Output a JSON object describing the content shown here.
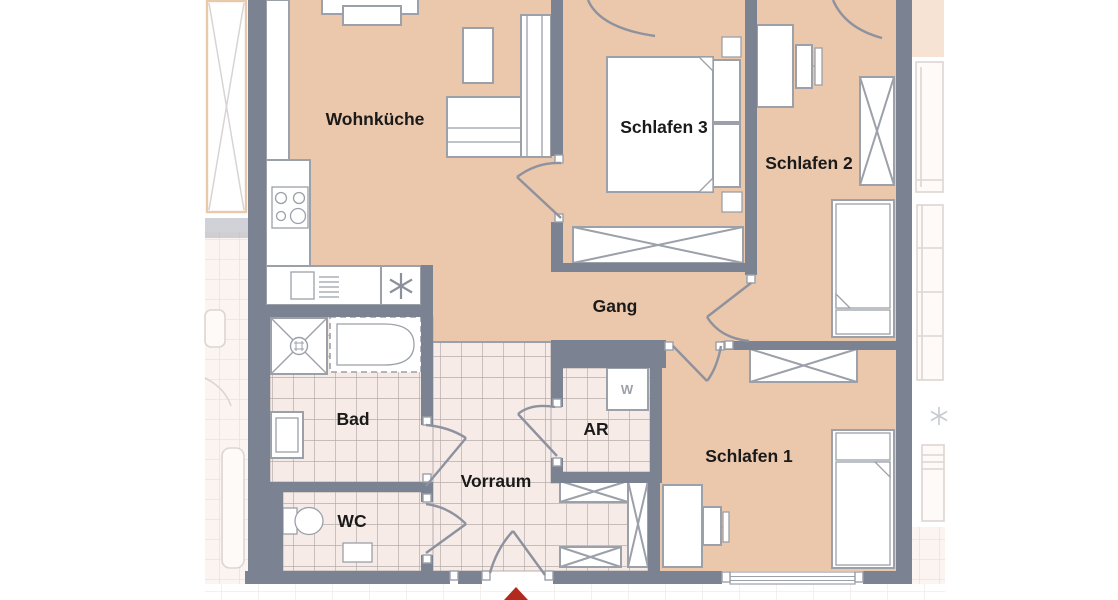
{
  "floorplan": {
    "title": "Apartment floor plan",
    "rooms": [
      {
        "id": "wohnkueche",
        "label": "Wohnküche"
      },
      {
        "id": "schlafen3",
        "label": "Schlafen 3"
      },
      {
        "id": "schlafen2",
        "label": "Schlafen 2"
      },
      {
        "id": "gang",
        "label": "Gang"
      },
      {
        "id": "bad",
        "label": "Bad"
      },
      {
        "id": "ar",
        "label": "AR"
      },
      {
        "id": "vorraum",
        "label": "Vorraum"
      },
      {
        "id": "wc",
        "label": "WC"
      },
      {
        "id": "schlafen1",
        "label": "Schlafen 1"
      }
    ],
    "appliances": {
      "washing_machine_label": "W"
    },
    "colors": {
      "walls": "#7b8392",
      "room_floor": "#ebc7ab",
      "tile_floor": "#f6ebe7",
      "tile_grid": "#b6aeac",
      "fixture_outline": "#9ba0a9",
      "label_text": "#1a1a1a",
      "entrance_marker": "#b22a1e",
      "faded_neighbor_tint": "#f6e3d3"
    }
  }
}
